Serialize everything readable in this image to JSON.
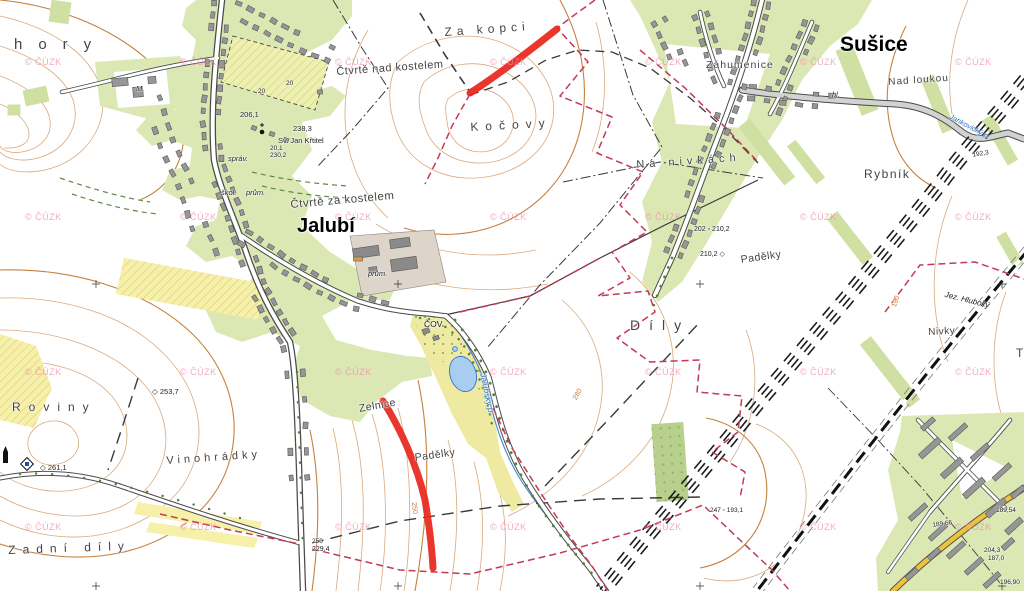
{
  "map": {
    "attribution": "© ČÚZK",
    "colors": {
      "highlight_red": "#e8281e",
      "boundary_red": "#c23a55",
      "water_blue": "#2f74c9",
      "contour_brown": "#d9a97e",
      "village_green": "#dce8b4",
      "field_yellow": "#f6f0a8",
      "watermark_pink": "#ec8ca8"
    },
    "watermark": {
      "text": "© ČÚZK",
      "positions": [
        [
          25,
          57
        ],
        [
          180,
          57
        ],
        [
          335,
          57
        ],
        [
          490,
          57
        ],
        [
          645,
          57
        ],
        [
          800,
          57
        ],
        [
          955,
          57
        ],
        [
          25,
          212
        ],
        [
          180,
          212
        ],
        [
          335,
          212
        ],
        [
          490,
          212
        ],
        [
          645,
          212
        ],
        [
          800,
          212
        ],
        [
          955,
          212
        ],
        [
          25,
          367
        ],
        [
          180,
          367
        ],
        [
          335,
          367
        ],
        [
          490,
          367
        ],
        [
          645,
          367
        ],
        [
          800,
          367
        ],
        [
          955,
          367
        ],
        [
          25,
          522
        ],
        [
          180,
          522
        ],
        [
          335,
          522
        ],
        [
          490,
          522
        ],
        [
          645,
          522
        ],
        [
          800,
          522
        ],
        [
          955,
          522
        ]
      ]
    },
    "highlight": {
      "color": "#e8281e",
      "width": 7,
      "segments": [
        {
          "id": "highlight-segment-north",
          "d": "M470,93 C495,77 523,56 557,29"
        },
        {
          "id": "highlight-segment-south",
          "d": "M383,401 C400,428 417,465 425,500 C430,530 432,550 433,568"
        }
      ]
    },
    "labels": [
      {
        "id": "hory",
        "text": "hory",
        "cls": "field",
        "x": 14,
        "y": 36,
        "fs": 15,
        "ls": 16
      },
      {
        "id": "ctvrte-nad-kostelem",
        "text": "Čtvrtě nad kostelem",
        "cls": "field",
        "x": 336,
        "y": 66,
        "fs": 11,
        "ls": 0.5,
        "rot": -4
      },
      {
        "id": "za-kopci",
        "text": "Za kopci",
        "cls": "field",
        "x": 444,
        "y": 25,
        "fs": 12,
        "ls": 5,
        "rot": -4
      },
      {
        "id": "kocovy",
        "text": "Kočovy",
        "cls": "field",
        "x": 470,
        "y": 120,
        "fs": 12,
        "ls": 7,
        "rot": -3
      },
      {
        "id": "susice",
        "text": "Sušice",
        "cls": "town",
        "x": 840,
        "y": 33,
        "fs": 21
      },
      {
        "id": "zahumenice",
        "text": "Záhumenice",
        "cls": "field",
        "x": 706,
        "y": 59,
        "fs": 10.5,
        "ls": 1
      },
      {
        "id": "nad-loukou",
        "text": "Nad loukou",
        "cls": "field",
        "x": 888,
        "y": 77,
        "fs": 10,
        "ls": 1,
        "rot": -4
      },
      {
        "id": "na-nivkach",
        "text": "Na nivkách",
        "cls": "field",
        "x": 636,
        "y": 159,
        "fs": 11,
        "ls": 5,
        "rot": -4
      },
      {
        "id": "rybnik",
        "text": "Rybník",
        "cls": "field",
        "x": 864,
        "y": 167,
        "fs": 12,
        "ls": 1.5
      },
      {
        "id": "ctvrte-za-kostelem",
        "text": "Čtvrtě za kostelem",
        "cls": "field",
        "x": 290,
        "y": 199,
        "fs": 11.5,
        "ls": 0.5,
        "rot": -5
      },
      {
        "id": "jalubi",
        "text": "Jalubí",
        "cls": "town",
        "x": 297,
        "y": 215,
        "fs": 20
      },
      {
        "id": "dily",
        "text": "Díly",
        "cls": "field",
        "x": 630,
        "y": 317,
        "fs": 14,
        "ls": 9
      },
      {
        "id": "padelky-east",
        "text": "Padělky",
        "cls": "field",
        "x": 740,
        "y": 254,
        "fs": 10.5,
        "ls": 0.5,
        "rot": -8
      },
      {
        "id": "nivky",
        "text": "Nivky",
        "cls": "field",
        "x": 928,
        "y": 327,
        "fs": 10,
        "ls": 0.5,
        "rot": -3
      },
      {
        "id": "roviny",
        "text": "Roviny",
        "cls": "field",
        "x": 12,
        "y": 400,
        "fs": 12,
        "ls": 8
      },
      {
        "id": "vinohradky",
        "text": "Vinohrádky",
        "cls": "field",
        "x": 166,
        "y": 455,
        "fs": 11,
        "ls": 4,
        "rot": -4
      },
      {
        "id": "zelnice",
        "text": "Zelnice",
        "cls": "field",
        "x": 358,
        "y": 403,
        "fs": 10.5,
        "ls": 0.5,
        "rot": -10
      },
      {
        "id": "padelky-south",
        "text": "Padělky",
        "cls": "field",
        "x": 414,
        "y": 452,
        "fs": 10.5,
        "ls": 0.5,
        "rot": -8
      },
      {
        "id": "zadni-dily",
        "text": "Zadní díly",
        "cls": "field",
        "x": 8,
        "y": 543,
        "fs": 12,
        "ls": 7,
        "rot": -2
      },
      {
        "id": "jez-hluboky",
        "text": "Jez. Hluboký",
        "cls": "tiny italic",
        "x": 946,
        "y": 290,
        "fs": 8,
        "rot": 14
      },
      {
        "id": "cov",
        "text": "ČOV",
        "cls": "tiny",
        "x": 424,
        "y": 319,
        "fs": 8.5
      },
      {
        "id": "prum-cov",
        "text": "prům.",
        "cls": "tiny italic",
        "x": 368,
        "y": 269,
        "fs": 7.5
      },
      {
        "id": "prum-village",
        "text": "prům.",
        "cls": "tiny italic",
        "x": 246,
        "y": 188,
        "fs": 7.5
      },
      {
        "id": "skol",
        "text": "škol.",
        "cls": "tiny italic",
        "x": 221,
        "y": 188,
        "fs": 7.5
      },
      {
        "id": "sprav",
        "text": "správ.",
        "cls": "tiny italic",
        "x": 228,
        "y": 154,
        "fs": 7.5
      },
      {
        "id": "sv-jan-krtitel",
        "text": "Sv. Jan Křtitel",
        "cls": "tiny",
        "x": 278,
        "y": 136,
        "fs": 7.5
      },
      {
        "id": "jalubsky-potok",
        "text": "Jalubský p.",
        "cls": "blue",
        "x": 488,
        "y": 372,
        "fs": 8.5,
        "rot": 78
      },
      {
        "id": "jankovicky-potok",
        "text": "Jankovický p.",
        "cls": "blue",
        "x": 952,
        "y": 112,
        "fs": 7.5,
        "rot": 28
      },
      {
        "id": "farm-m",
        "text": "M.",
        "cls": "tiny italic",
        "x": 136,
        "y": 84,
        "fs": 7.5
      },
      {
        "id": "hl",
        "text": "hl.",
        "cls": "tiny italic",
        "x": 832,
        "y": 90,
        "fs": 7.5
      },
      {
        "id": "t-partial",
        "text": "T",
        "cls": "field",
        "x": 1016,
        "y": 346,
        "fs": 12
      },
      {
        "id": "elev-253-7",
        "text": "◇ 253,7",
        "cls": "elev",
        "x": 152,
        "y": 387,
        "fs": 7.5
      },
      {
        "id": "elev-261-1",
        "text": "◇ 261,1",
        "cls": "elev",
        "x": 40,
        "y": 463,
        "fs": 7.5
      },
      {
        "id": "elev-206-1",
        "text": "206,1",
        "cls": "elev",
        "x": 240,
        "y": 110,
        "fs": 7.5
      },
      {
        "id": "elev-238-3",
        "text": "238,3",
        "cls": "elev",
        "x": 293,
        "y": 124,
        "fs": 7.5
      },
      {
        "id": "elev-20-1",
        "text": "20,1",
        "cls": "elev",
        "x": 270,
        "y": 145,
        "fs": 6.5
      },
      {
        "id": "elev-230-2",
        "text": "230,2",
        "cls": "elev",
        "x": 270,
        "y": 152,
        "fs": 6.5
      },
      {
        "id": "elev-202-210-2",
        "text": "202 ▫ 210,2",
        "cls": "elev",
        "x": 694,
        "y": 226,
        "fs": 7
      },
      {
        "id": "elev-210-2",
        "text": "210,2 ◇",
        "cls": "elev",
        "x": 700,
        "y": 250,
        "fs": 7
      },
      {
        "id": "elev-250",
        "text": "250",
        "cls": "elev",
        "x": 312,
        "y": 538,
        "fs": 6.5
      },
      {
        "id": "elev-229-4",
        "text": "229,4",
        "cls": "elev",
        "x": 312,
        "y": 546,
        "fs": 7
      },
      {
        "id": "elev-192-3",
        "text": "192,3",
        "cls": "elev",
        "x": 972,
        "y": 152,
        "fs": 6.5,
        "rot": -10
      },
      {
        "id": "elev-247-193-1",
        "text": "247 ▫ 193,1",
        "cls": "elev",
        "x": 710,
        "y": 507,
        "fs": 6.5
      },
      {
        "id": "elev-189-66",
        "text": "189,66",
        "cls": "elev",
        "x": 932,
        "y": 522,
        "fs": 6.5,
        "rot": -8
      },
      {
        "id": "elev-189-54",
        "text": "189,54",
        "cls": "elev",
        "x": 996,
        "y": 507,
        "fs": 6.5
      },
      {
        "id": "elev-204-3",
        "text": "204,3",
        "cls": "elev",
        "x": 984,
        "y": 547,
        "fs": 6.5
      },
      {
        "id": "elev-187-0",
        "text": "187,0",
        "cls": "elev",
        "x": 988,
        "y": 555,
        "fs": 6.5
      },
      {
        "id": "elev-196-90",
        "text": "196,90",
        "cls": "elev",
        "x": 1000,
        "y": 579,
        "fs": 6.5
      },
      {
        "id": "orchard-20a",
        "text": "20",
        "cls": "elev",
        "x": 258,
        "y": 88,
        "fs": 6.5
      },
      {
        "id": "orchard-20b",
        "text": "20",
        "cls": "elev",
        "x": 286,
        "y": 80,
        "fs": 6.5
      },
      {
        "id": "contour-280",
        "text": "280",
        "cls": "orange",
        "x": 572,
        "y": 398,
        "fs": 7,
        "rot": -62
      },
      {
        "id": "contour-250",
        "text": "250",
        "cls": "orange",
        "x": 417,
        "y": 502,
        "fs": 7,
        "rot": 84
      },
      {
        "id": "contour-190",
        "text": "190",
        "cls": "orange",
        "x": 891,
        "y": 306,
        "fs": 7,
        "rot": -72
      }
    ]
  }
}
